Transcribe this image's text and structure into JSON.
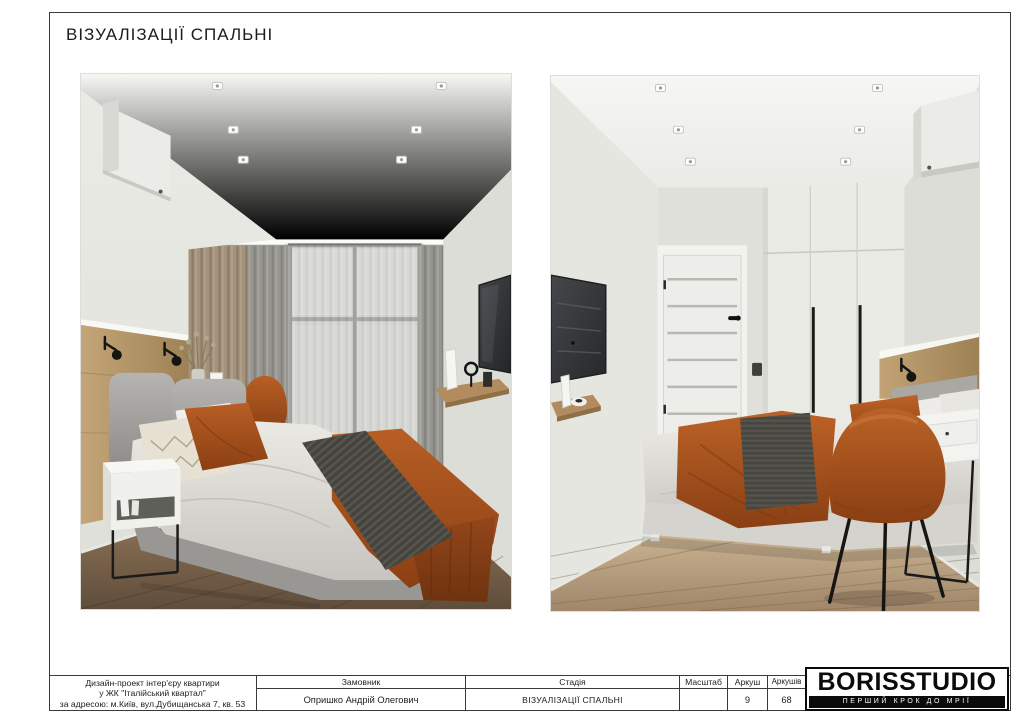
{
  "sheet": {
    "title": "ВІЗУАЛІЗАЦІЇ СПАЛЬНІ"
  },
  "title_block": {
    "project": {
      "line1": "Дизайн-проект інтер'єру квартири",
      "line2": "у ЖК \"Італійський квартал\"",
      "line3": "за адресою: м.Київ, вул.Дубищанська 7, кв. 53"
    },
    "customer_label": "Замовник",
    "customer_value": "Опришко Андрій Олегович",
    "stage_label": "Стадія",
    "stage_value": "ВІЗУАЛІЗАЦІЇ СПАЛЬНІ",
    "scale_label": "Масштаб",
    "scale_value": "",
    "sheet_label": "Аркуш",
    "sheet_value": "9",
    "sheets_label": "Аркушів",
    "sheets_value": "68",
    "logo_name": "BORISSTUDIO",
    "logo_tagline": "ПЕРШИЙ КРОК ДО МРІЇ"
  },
  "colors": {
    "line": "#3a3a3a",
    "accent_rust": "#a6511e",
    "wood": "#b3916a",
    "wall": "#e3e4de",
    "floor_dark": "#7c6750",
    "floor_light": "#c3ac8c"
  }
}
